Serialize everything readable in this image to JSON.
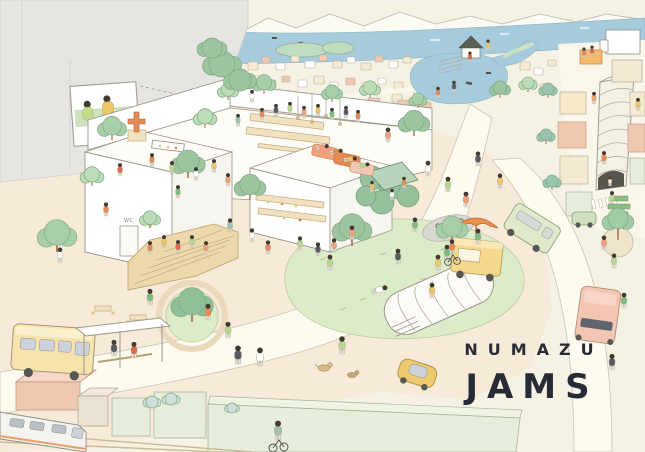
{
  "title": {
    "top": "NUMAZU",
    "bottom": "JAMS"
  },
  "labels": {
    "restroom_sign": "WC"
  },
  "palette": {
    "background": "#f6f2e3",
    "plaza": "#f8ead9",
    "road": "#fdfaef",
    "wall_gray": "#e6e5e2",
    "sea_blue": "#a6cbdc",
    "lawn_green": "#dcebc8",
    "tree_green": "#a8cfaa",
    "hedge_green": "#97c09d",
    "wood_tan": "#ecd8ab",
    "building_pink": "#f0c8b2",
    "building_cream": "#f5ead0",
    "building_green": "#e6eedb",
    "bus_yellow": "#f7e4ac",
    "car_yellow": "#edca6e",
    "umbrella_orange": "#e8914b",
    "train_white": "#f3f3f0",
    "title_text": "#272b36",
    "outline": "#9b968b"
  },
  "scene": {
    "blocks": [
      [
        248,
        62,
        10,
        8,
        "#f5ead0"
      ],
      [
        262,
        57,
        8,
        6,
        "#f0c8b2"
      ],
      [
        276,
        63,
        9,
        7,
        "#ffffff"
      ],
      [
        291,
        56,
        8,
        6,
        "#f5ead0"
      ],
      [
        305,
        61,
        10,
        7,
        "#ffffff"
      ],
      [
        319,
        55,
        8,
        6,
        "#f0c8b2"
      ],
      [
        333,
        61,
        9,
        7,
        "#f5ead0"
      ],
      [
        347,
        57,
        8,
        6,
        "#ffffff"
      ],
      [
        361,
        63,
        10,
        7,
        "#f5ead0"
      ],
      [
        375,
        56,
        8,
        6,
        "#f0c8b2"
      ],
      [
        389,
        61,
        9,
        7,
        "#ffffff"
      ],
      [
        403,
        57,
        8,
        6,
        "#f5ead0"
      ],
      [
        250,
        76,
        9,
        7,
        "#ffffff"
      ],
      [
        266,
        80,
        10,
        8,
        "#f5ead0"
      ],
      [
        282,
        76,
        8,
        6,
        "#f0c8b2"
      ],
      [
        298,
        80,
        9,
        7,
        "#ffffff"
      ],
      [
        314,
        76,
        10,
        8,
        "#f5ead0"
      ],
      [
        330,
        82,
        8,
        6,
        "#ffffff"
      ],
      [
        346,
        78,
        9,
        7,
        "#f0c8b2"
      ],
      [
        362,
        82,
        10,
        8,
        "#f5ead0"
      ],
      [
        378,
        78,
        8,
        6,
        "#ffffff"
      ],
      [
        394,
        82,
        9,
        7,
        "#f5ead0"
      ],
      [
        256,
        94,
        12,
        9,
        "#f0c8b2"
      ],
      [
        276,
        98,
        10,
        8,
        "#f5ead0"
      ],
      [
        296,
        94,
        9,
        7,
        "#ffffff"
      ],
      [
        316,
        98,
        12,
        9,
        "#f5ead0"
      ],
      [
        342,
        96,
        10,
        8,
        "#ffffff"
      ],
      [
        368,
        98,
        12,
        9,
        "#f0c8b2"
      ],
      [
        392,
        94,
        10,
        8,
        "#f5ead0"
      ],
      [
        414,
        90,
        11,
        8,
        "#f5ead0"
      ],
      [
        430,
        82,
        10,
        8,
        "#ffffff"
      ],
      [
        520,
        62,
        10,
        8,
        "#f5ead0"
      ],
      [
        534,
        68,
        9,
        7,
        "#ffffff"
      ],
      [
        548,
        60,
        8,
        6,
        "#f5ead0"
      ],
      [
        526,
        80,
        10,
        8,
        "#ffffff"
      ],
      [
        540,
        84,
        9,
        7,
        "#f5ead0"
      ],
      [
        398,
        100,
        15,
        11,
        "#f0c8b2"
      ],
      [
        418,
        102,
        13,
        10,
        "#f0c8b2"
      ]
    ],
    "trees": [
      [
        57,
        252,
        15,
        "#a8cfaa"
      ],
      [
        112,
        140,
        11,
        "#a8cfaa"
      ],
      [
        205,
        128,
        9,
        "#bcdcb8"
      ],
      [
        188,
        178,
        13,
        "#9cc49e"
      ],
      [
        250,
        200,
        12,
        "#9cc49e"
      ],
      [
        150,
        228,
        8,
        "#bcdcb8"
      ],
      [
        192,
        322,
        16,
        "#8fbf98"
      ],
      [
        228,
        100,
        8,
        "#bcdcb8"
      ],
      [
        264,
        94,
        9,
        "#a8cfaa"
      ],
      [
        332,
        102,
        8,
        "#a8cfaa"
      ],
      [
        370,
        98,
        8,
        "#bcdcb8"
      ],
      [
        414,
        136,
        12,
        "#9cc49e"
      ],
      [
        352,
        246,
        15,
        "#9cc49e"
      ],
      [
        452,
        242,
        12,
        "#a8cfaa"
      ],
      [
        500,
        98,
        8,
        "#9cc49e"
      ],
      [
        528,
        92,
        7,
        "#bcdcb8"
      ],
      [
        548,
        98,
        7,
        "#9ac4ae"
      ],
      [
        546,
        144,
        7,
        "#9ac4ae"
      ],
      [
        552,
        190,
        7,
        "#9ac4ae"
      ],
      [
        418,
        108,
        7,
        "#a8cfaa"
      ],
      [
        618,
        234,
        12,
        "#9fcba5"
      ],
      [
        92,
        186,
        9,
        "#bcdcb8"
      ],
      [
        222,
        64,
        13,
        "#9cc49e",
        1
      ],
      [
        240,
        80,
        11,
        "#9cc49e",
        1
      ],
      [
        212,
        48,
        10,
        "#9cc49e",
        1
      ],
      [
        152,
        402,
        6,
        "#cfe0da",
        1
      ],
      [
        171,
        399,
        6,
        "#cfe0da",
        1
      ],
      [
        232,
        408,
        5,
        "#cfe0da",
        1
      ]
    ],
    "people": [
      [
        262,
        120,
        "#e58a52",
        0.75
      ],
      [
        276,
        116,
        "#565b66",
        0.75
      ],
      [
        290,
        114,
        "#b5d88e",
        0.75
      ],
      [
        304,
        118,
        "#ef9f7a",
        0.75
      ],
      [
        318,
        116,
        "#eec468",
        0.75
      ],
      [
        332,
        120,
        "#7fbc82",
        0.75
      ],
      [
        346,
        118,
        "#565b66",
        0.75
      ],
      [
        358,
        122,
        "#e58a52",
        0.75
      ],
      [
        252,
        102,
        "#ffffff",
        0.75
      ],
      [
        238,
        126,
        "#9ac4ae",
        0.75
      ],
      [
        152,
        166,
        "#e58a52",
        0.8
      ],
      [
        172,
        174,
        "#b5d88e",
        0.8
      ],
      [
        196,
        180,
        "#ffffff",
        0.8
      ],
      [
        214,
        172,
        "#eec468",
        0.8
      ],
      [
        228,
        186,
        "#ef9f7a",
        0.8
      ],
      [
        178,
        198,
        "#7fbc82",
        0.8
      ],
      [
        120,
        176,
        "#d96a4a",
        0.8
      ],
      [
        60,
        262,
        "#ffffff",
        0.9
      ],
      [
        106,
        216,
        "#e58a52",
        0.85
      ],
      [
        150,
        254,
        "#e58a52",
        0.8
      ],
      [
        164,
        248,
        "#eec468",
        0.8
      ],
      [
        178,
        253,
        "#d96a4a",
        0.8
      ],
      [
        192,
        248,
        "#b5d88e",
        0.8
      ],
      [
        206,
        254,
        "#ef9f7a",
        0.8
      ],
      [
        252,
        242,
        "#ffffff",
        0.85
      ],
      [
        268,
        254,
        "#e58a52",
        0.85
      ],
      [
        300,
        250,
        "#b5d88e",
        0.85
      ],
      [
        318,
        256,
        "#565b66",
        0.85
      ],
      [
        334,
        252,
        "#ef9f7a",
        0.85
      ],
      [
        230,
        232,
        "#9ac4ae",
        0.85
      ],
      [
        330,
        153,
        "#e58a52",
        0.8,
        78
      ],
      [
        344,
        160,
        "#eec468",
        0.8,
        82
      ],
      [
        357,
        167,
        "#b5d88e",
        0.8,
        76
      ],
      [
        316,
        148,
        "#ef9f7a",
        0.8,
        80
      ],
      [
        372,
        192,
        "#eec468",
        0.7
      ],
      [
        392,
        200,
        "#ffffff",
        0.7
      ],
      [
        404,
        188,
        "#e58a52",
        0.7
      ],
      [
        428,
        176,
        "#ffffff",
        0.95
      ],
      [
        448,
        192,
        "#b5d88e",
        0.95
      ],
      [
        466,
        207,
        "#ef9f7a",
        0.95
      ],
      [
        478,
        166,
        "#565b66",
        0.9
      ],
      [
        500,
        188,
        "#eec468",
        0.9
      ],
      [
        415,
        232,
        "#7fbc82",
        0.9
      ],
      [
        388,
        142,
        "#ef9f7a",
        0.9
      ],
      [
        330,
        270,
        "#b5d88e",
        0.95
      ],
      [
        372,
        292,
        "#ffffff",
        1,
        72
      ],
      [
        398,
        264,
        "#565b66",
        0.95
      ],
      [
        432,
        298,
        "#eec468",
        0.95
      ],
      [
        478,
        244,
        "#7fbc82",
        0.95
      ],
      [
        352,
        240,
        "#ef9f7a",
        0.9
      ],
      [
        208,
        320,
        "#e58a52",
        1
      ],
      [
        228,
        338,
        "#b5d88e",
        1
      ],
      [
        447,
        260,
        "#7fbc82",
        0.95
      ],
      [
        438,
        270,
        "#eec468",
        0.95
      ],
      [
        238,
        364,
        "#565b66",
        1.15
      ],
      [
        260,
        366,
        "#ffffff",
        1.15
      ],
      [
        342,
        354,
        "#b5d88e",
        1.1
      ],
      [
        114,
        356,
        "#565b66",
        1
      ],
      [
        134,
        358,
        "#d96a4a",
        1
      ],
      [
        150,
        305,
        "#7fbc82",
        1
      ],
      [
        604,
        250,
        "#ef9f7a",
        0.9
      ],
      [
        614,
        268,
        "#b5d88e",
        0.9
      ],
      [
        624,
        308,
        "#7fbc82",
        0.95
      ],
      [
        612,
        370,
        "#565b66",
        1
      ],
      [
        604,
        164,
        "#e58a52",
        0.8
      ],
      [
        612,
        204,
        "#b5d88e",
        0.8
      ],
      [
        594,
        104,
        "#ef9f7a",
        0.75
      ],
      [
        638,
        110,
        "#eec468",
        0.75
      ],
      [
        610,
        186,
        "#efe6d2",
        0.6
      ],
      [
        438,
        98,
        "#e58a52",
        0.7
      ],
      [
        454,
        92,
        "#565b66",
        0.7
      ],
      [
        470,
        62,
        "#d96a4a",
        0.65
      ],
      [
        488,
        50,
        "#eec468",
        0.65
      ],
      [
        584,
        58,
        "#e58a52",
        0.65
      ],
      [
        592,
        56,
        "#d96a4a",
        0.65
      ],
      [
        452,
        254,
        "#e58a52",
        0.9
      ],
      [
        278,
        440,
        "#9ac4ae",
        1.2
      ]
    ]
  }
}
